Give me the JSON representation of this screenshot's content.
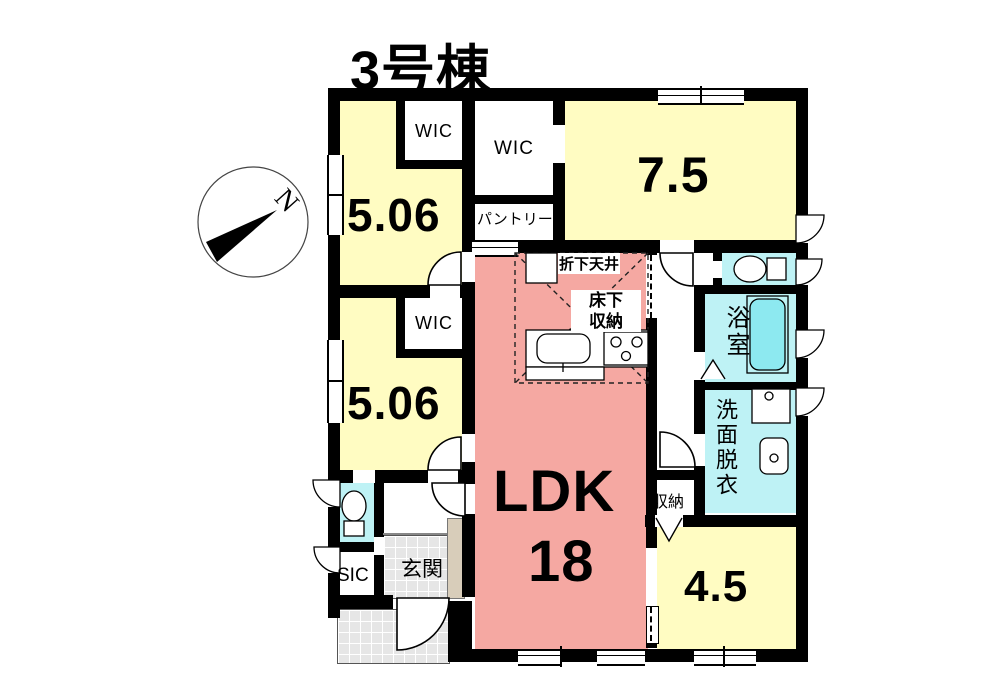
{
  "title": "3号棟",
  "compass": {
    "north_label": "N"
  },
  "rooms": {
    "bedroom_top_left": {
      "label": "5.06"
    },
    "bedroom_mid_left": {
      "label": "5.06"
    },
    "bedroom_top_right": {
      "label": "7.5"
    },
    "bedroom_bottom_right": {
      "label": "4.5"
    },
    "ldk": {
      "label": "LDK",
      "size_label": "18"
    },
    "wic_top_left": {
      "label": "WIC"
    },
    "wic_top_mid": {
      "label": "WIC"
    },
    "wic_mid_left": {
      "label": "WIC"
    },
    "pantry": {
      "label": "パントリー"
    },
    "bath": {
      "label": "浴室"
    },
    "washroom": {
      "label": "洗面脱衣"
    },
    "storage": {
      "label": "収納"
    },
    "sic": {
      "label": "SIC"
    },
    "entrance": {
      "label": "玄関"
    },
    "dropped_ceiling": {
      "label": "折下天井"
    },
    "underfloor_storage": {
      "label_line1": "床下",
      "label_line2": "収納"
    }
  },
  "colors": {
    "bedroom_yellow": "#FFFCC2",
    "ldk_pink": "#F5A8A2",
    "wet_area_cyan": "#BEF2F5",
    "bathtub_cyan": "#8DE9F0",
    "tile_grey": "#E6E6E6",
    "step_beige": "#D8CDBA",
    "wall_black": "#000000"
  }
}
